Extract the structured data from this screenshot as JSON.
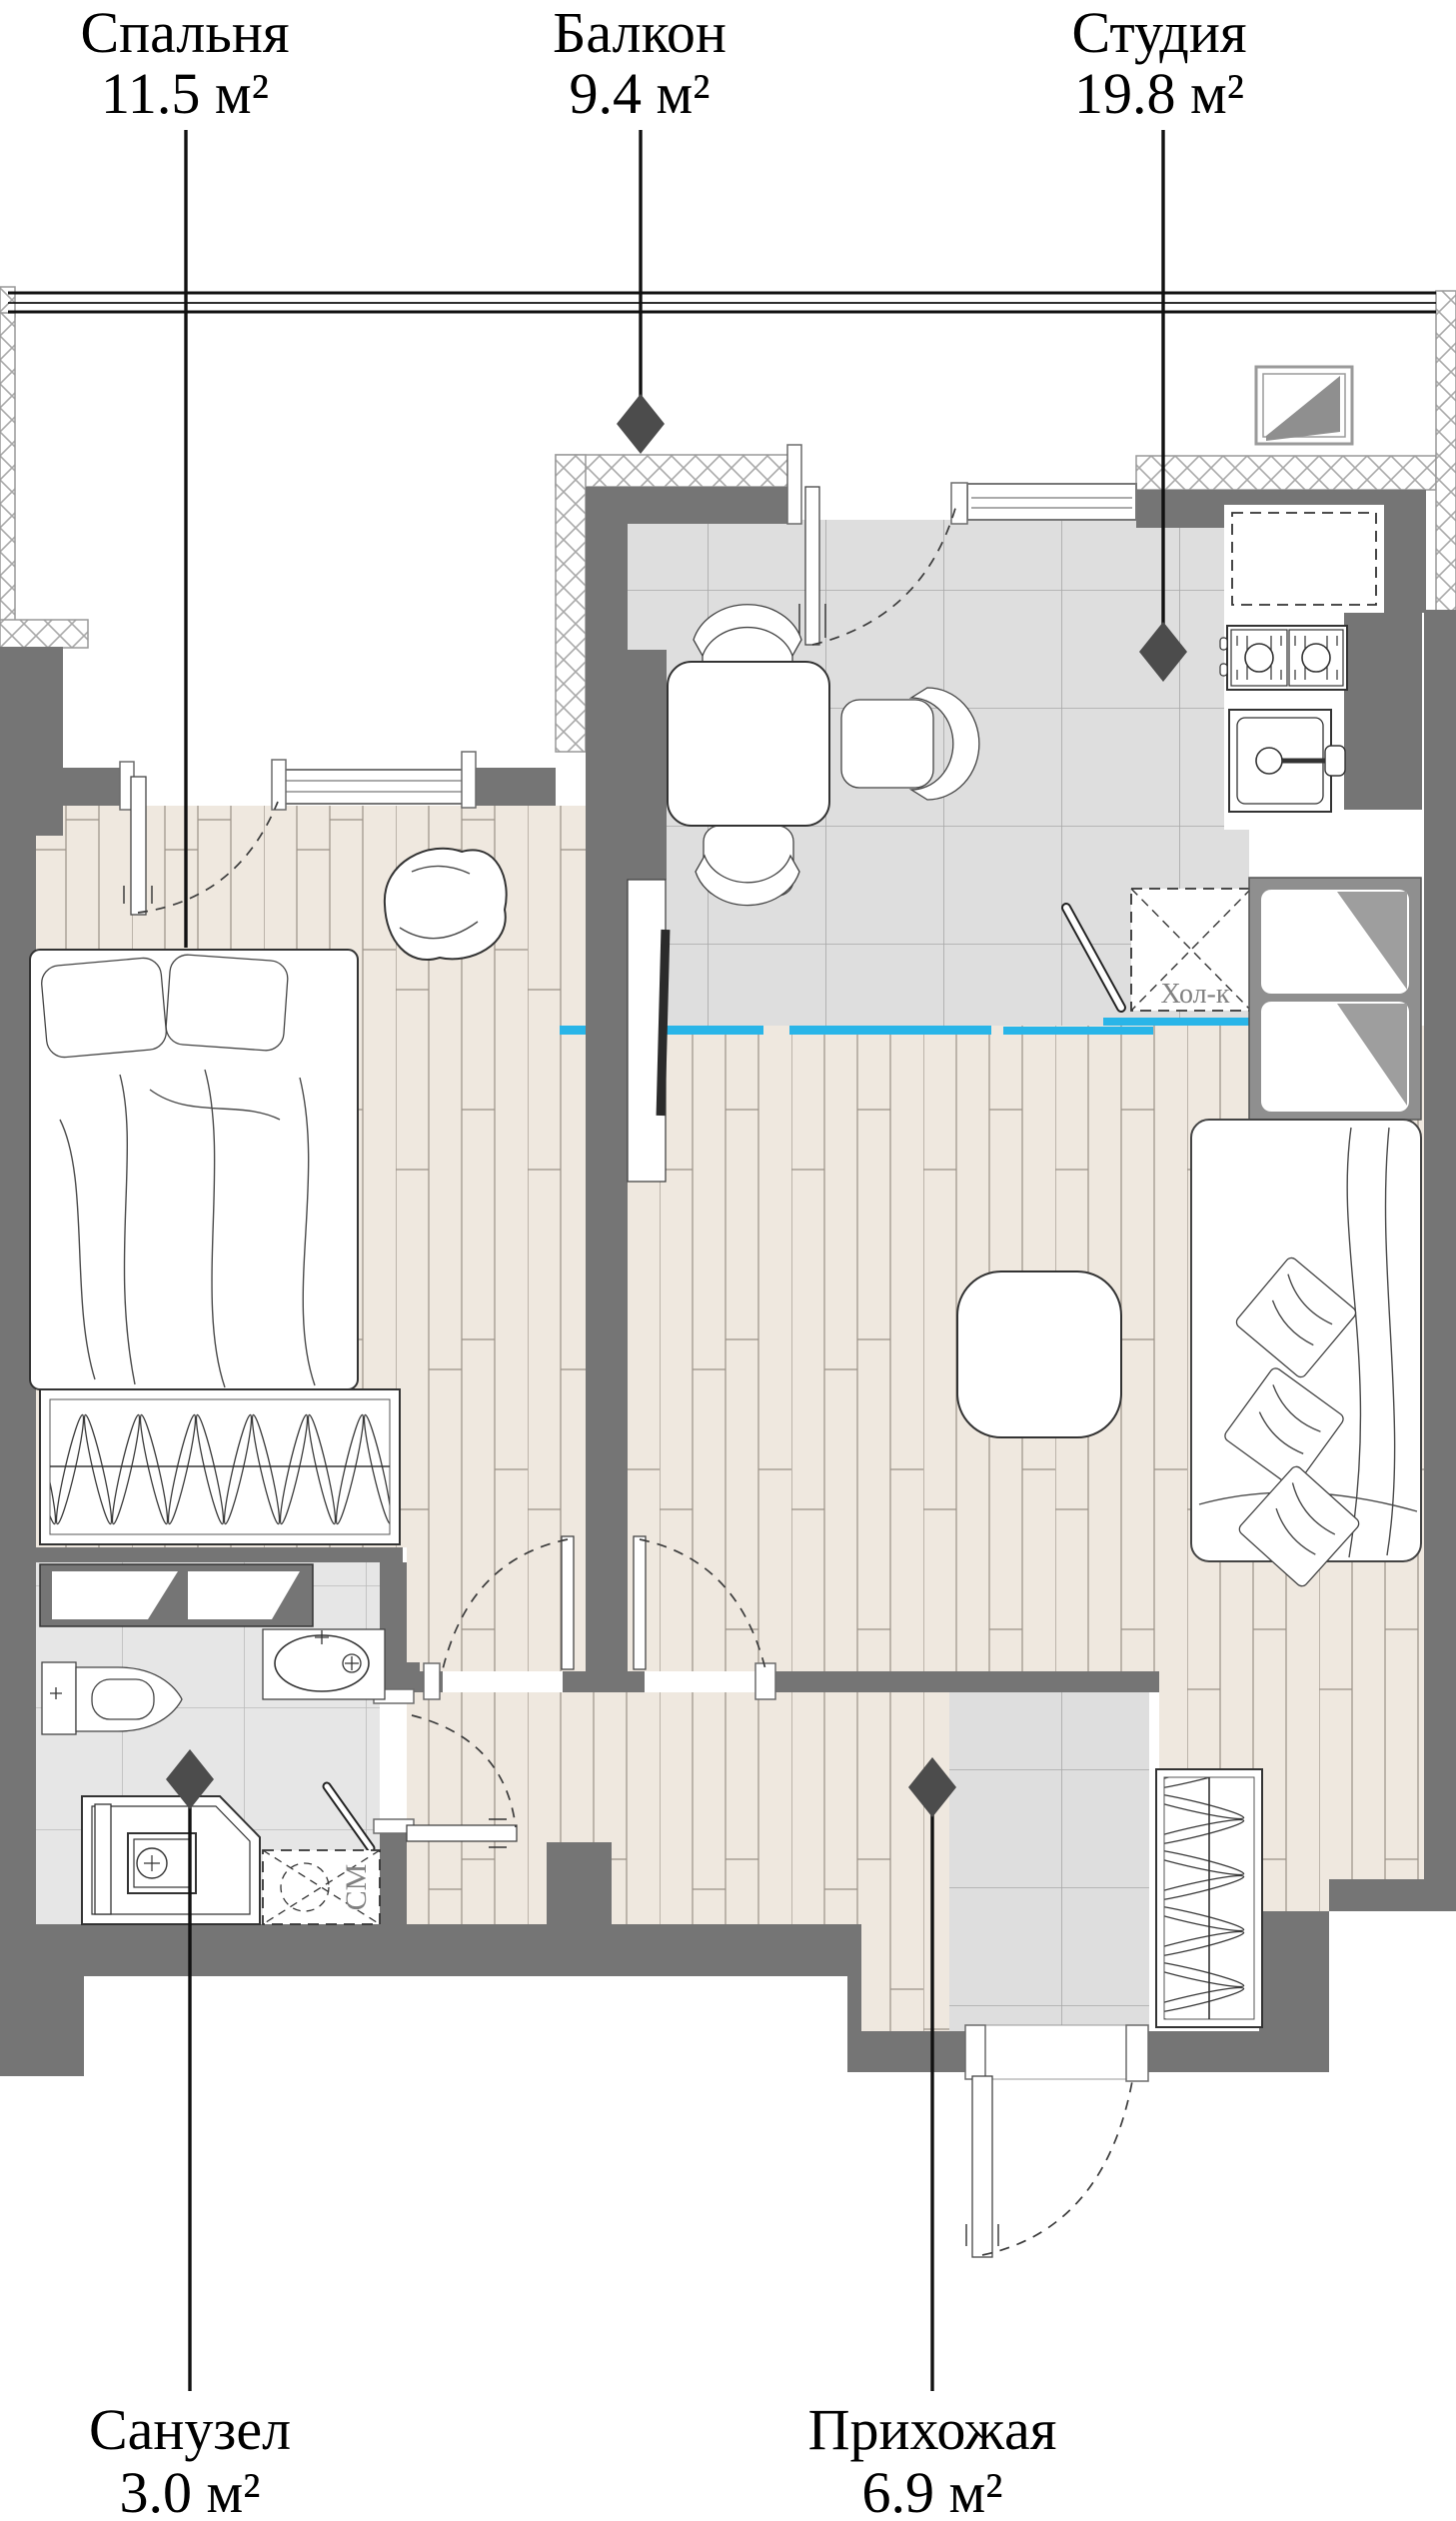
{
  "rooms": [
    {
      "key": "bedroom",
      "name": "Спальня",
      "area": "11.5 м²"
    },
    {
      "key": "balcony",
      "name": "Балкон",
      "area": "9.4 м²"
    },
    {
      "key": "studio",
      "name": "Студия",
      "area": "19.8 м²"
    },
    {
      "key": "bathroom",
      "name": "Санузел",
      "area": "3.0 м²"
    },
    {
      "key": "hallway",
      "name": "Прихожая",
      "area": "6.9 м²"
    }
  ],
  "appliances": {
    "fridge_label": "Хол-к",
    "washer_label": "СМ"
  },
  "colors": {
    "wall_gray": "#757575",
    "accent_cyan": "#29b5e8",
    "wood_floor": "#efe8df",
    "tile_floor": "#dedede",
    "bath_tile": "#e6e6e6",
    "annotation_gray": "#808080",
    "line_black": "#111111"
  }
}
